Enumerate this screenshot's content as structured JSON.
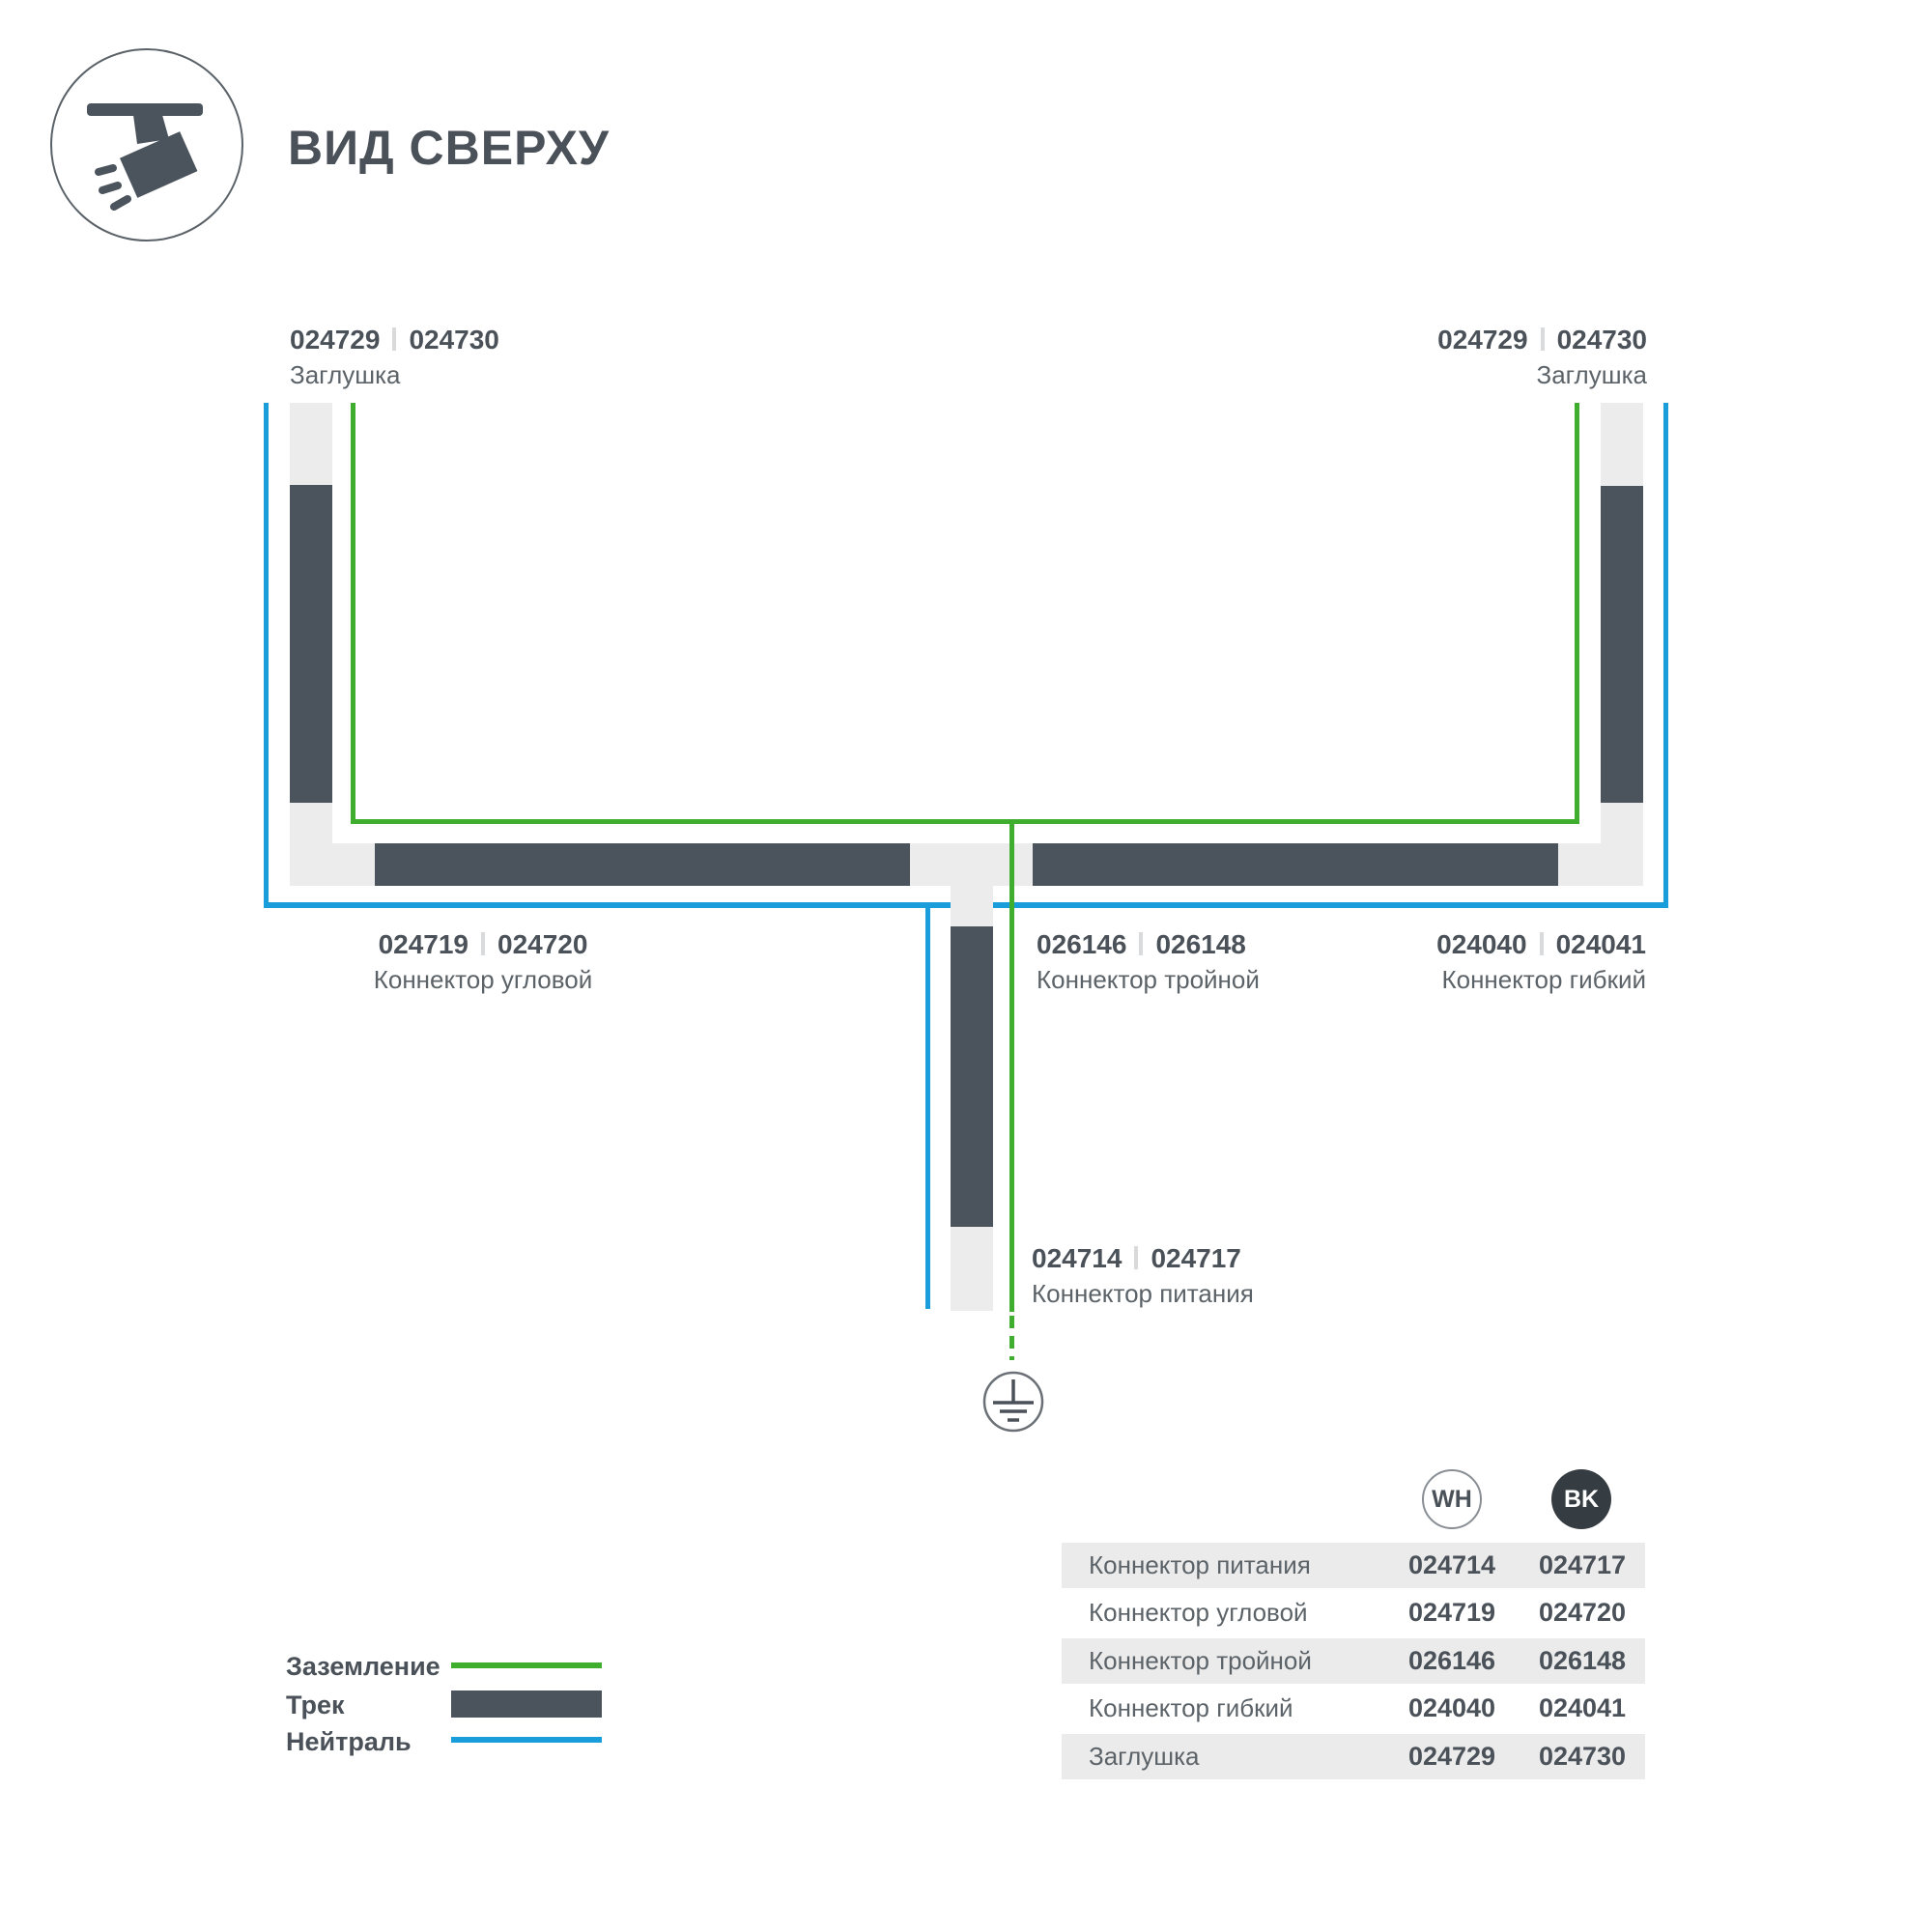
{
  "header": {
    "title": "ВИД СВЕРХУ"
  },
  "diagram": {
    "labels": {
      "endcap_left": {
        "wh": "024729",
        "bk": "024730",
        "name": "Заглушка"
      },
      "endcap_right": {
        "wh": "024729",
        "bk": "024730",
        "name": "Заглушка"
      },
      "corner": {
        "wh": "024719",
        "bk": "024720",
        "name": "Коннектор угловой"
      },
      "triple": {
        "wh": "026146",
        "bk": "026148",
        "name": "Коннектор тройной"
      },
      "flex": {
        "wh": "024040",
        "bk": "024041",
        "name": "Коннектор гибкий"
      },
      "power": {
        "wh": "024714",
        "bk": "024717",
        "name": "Коннектор питания"
      }
    },
    "icons": [
      "spotlight-track-icon",
      "earth-ground-icon"
    ]
  },
  "legend": {
    "items": [
      {
        "label": "Заземление",
        "swatch": "ground-green-line"
      },
      {
        "label": "Трек",
        "swatch": "track-dark-bar"
      },
      {
        "label": "Нейтраль",
        "swatch": "neutral-blue-line"
      }
    ]
  },
  "table": {
    "columns": [
      {
        "label": "WH"
      },
      {
        "label": "BK"
      }
    ],
    "rows": [
      {
        "name": "Коннектор питания",
        "wh": "024714",
        "bk": "024717"
      },
      {
        "name": "Коннектор угловой",
        "wh": "024719",
        "bk": "024720"
      },
      {
        "name": "Коннектор тройной",
        "wh": "026146",
        "bk": "026148"
      },
      {
        "name": "Коннектор гибкий",
        "wh": "024040",
        "bk": "024041"
      },
      {
        "name": "Заглушка",
        "wh": "024729",
        "bk": "024730"
      }
    ]
  },
  "colors": {
    "ground_green": "#3FAE2F",
    "neutral_blue": "#1A9DDB",
    "track_dark": "#4B545C",
    "track_light": "#ECECEC",
    "table_row_gray": "#EBEBEB",
    "bk_circle": "#363D42",
    "text_dark": "#4A5158",
    "text_gray": "#5C6368"
  }
}
